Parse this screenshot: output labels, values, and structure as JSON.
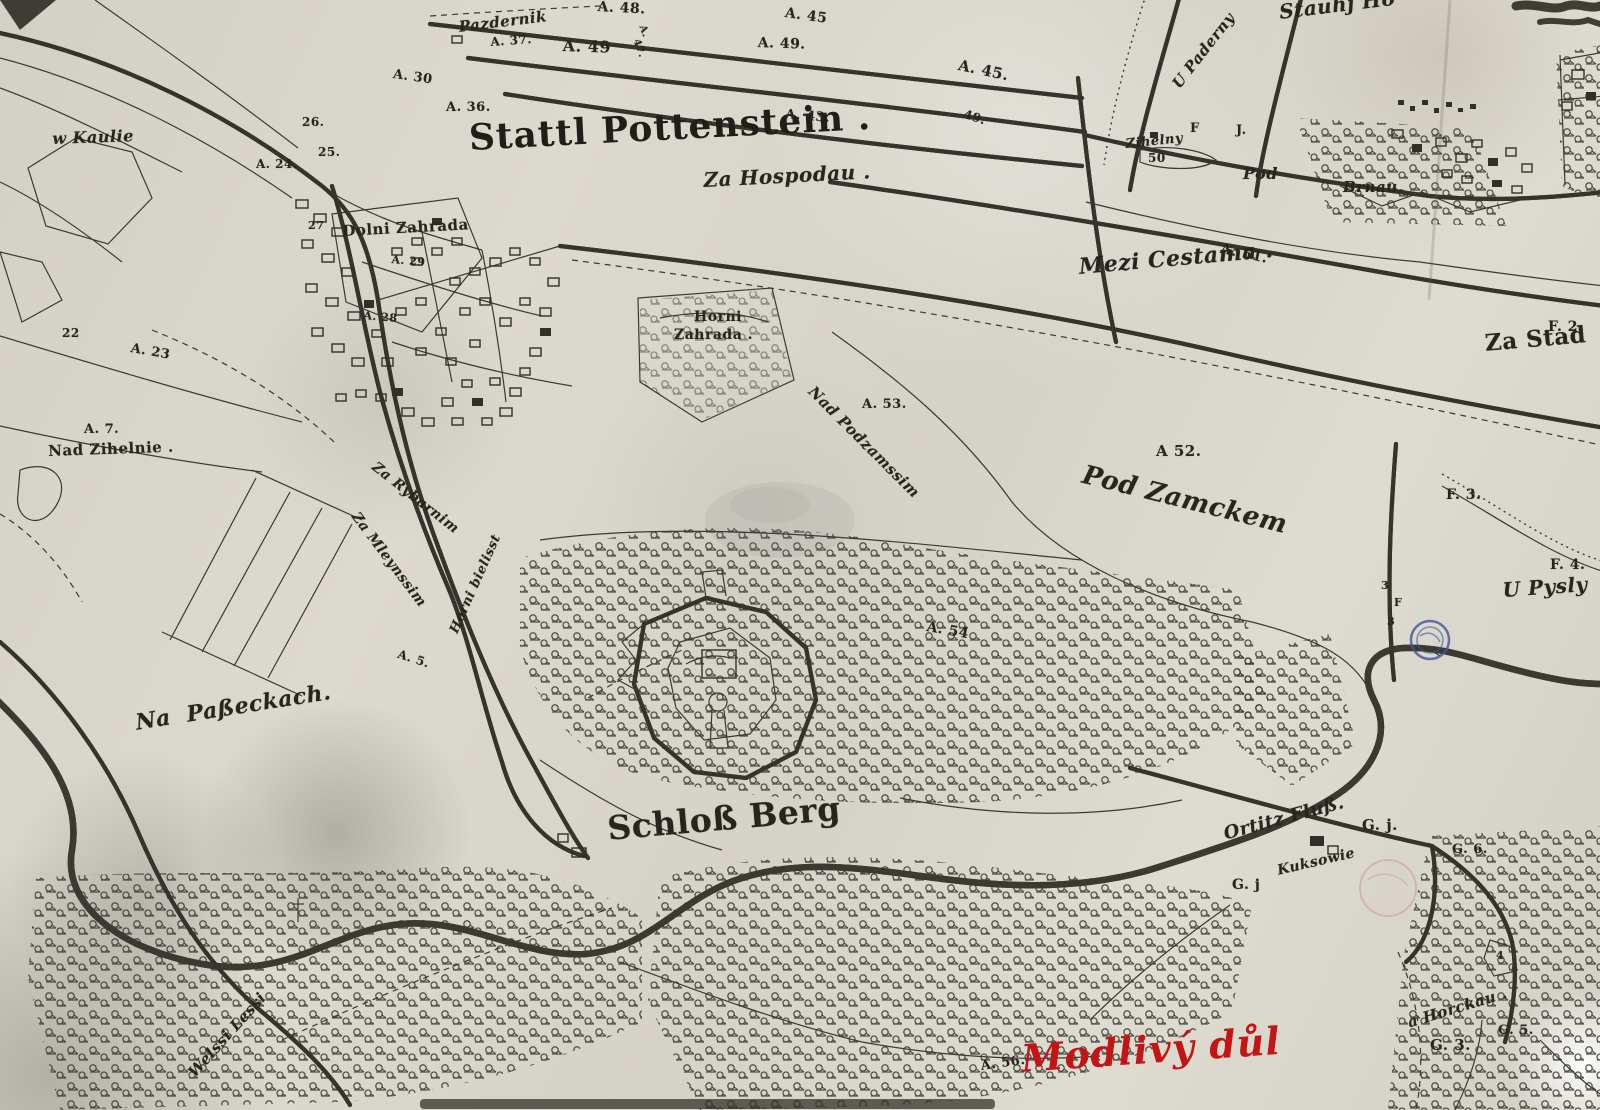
{
  "map": {
    "title": {
      "text": "Stattl Pottenstein ."
    },
    "colors": {
      "paper": "#d8d5cb",
      "ink": "#34342d",
      "red_ink": "#c41414",
      "blue_stamp": "#41549e",
      "red_stamp": "#c87878"
    },
    "annotations": {
      "red_note": "Modlivý důl"
    },
    "stamps": [
      {
        "type": "blue-double-circle",
        "x": 1430,
        "y": 640
      },
      {
        "type": "faint-red-seal",
        "x": 1388,
        "y": 888
      }
    ],
    "labels": [
      {
        "t": "A. 48.",
        "x": 598,
        "y": 0,
        "s": 14,
        "r": 3
      },
      {
        "t": "Pazdernik",
        "x": 458,
        "y": 20,
        "s": 15,
        "r": -7,
        "cls": "script"
      },
      {
        "t": "A. 37.",
        "x": 490,
        "y": 36,
        "s": 12,
        "r": -4
      },
      {
        "t": "A. 49",
        "x": 563,
        "y": 38,
        "s": 16,
        "r": 2
      },
      {
        "t": "A.",
        "x": 646,
        "y": 24,
        "s": 10,
        "r": 70
      },
      {
        "t": "47.",
        "x": 640,
        "y": 38,
        "s": 10,
        "r": 70
      },
      {
        "t": "A. 49.",
        "x": 758,
        "y": 36,
        "s": 14,
        "r": 2
      },
      {
        "t": "A. 45",
        "x": 786,
        "y": 6,
        "s": 14,
        "r": 8
      },
      {
        "t": "A. 45.",
        "x": 960,
        "y": 58,
        "s": 15,
        "r": 12
      },
      {
        "t": "49.",
        "x": 966,
        "y": 108,
        "s": 12,
        "r": 18
      },
      {
        "t": "A. 30",
        "x": 394,
        "y": 68,
        "s": 13,
        "r": 8
      },
      {
        "t": "A. 36.",
        "x": 446,
        "y": 101,
        "s": 13
      },
      {
        "t": "A. 43.",
        "x": 786,
        "y": 108,
        "s": 13,
        "r": 5
      },
      {
        "t": "U Paderny",
        "x": 1170,
        "y": 82,
        "s": 15,
        "r": -52,
        "cls": "script"
      },
      {
        "t": "Stauhj Ho",
        "x": 1278,
        "y": 2,
        "s": 20,
        "r": -7,
        "cls": "script"
      },
      {
        "t": "F",
        "x": 1190,
        "y": 122,
        "s": 13
      },
      {
        "t": "J.",
        "x": 1236,
        "y": 124,
        "s": 13
      },
      {
        "t": "Zihelny",
        "x": 1125,
        "y": 138,
        "s": 13,
        "r": -6,
        "cls": "script"
      },
      {
        "t": "50",
        "x": 1148,
        "y": 152,
        "s": 12
      },
      {
        "t": "Pod",
        "x": 1243,
        "y": 166,
        "s": 16,
        "cls": "script"
      },
      {
        "t": "Brnau.",
        "x": 1343,
        "y": 180,
        "s": 15,
        "cls": "script"
      },
      {
        "t": "Za Hospodau .",
        "x": 703,
        "y": 170,
        "s": 20,
        "r": -3,
        "cls": "script"
      },
      {
        "t": "Mezi Cestama .",
        "x": 1078,
        "y": 256,
        "s": 22,
        "r": -5,
        "cls": "script"
      },
      {
        "t": "A. 51.",
        "x": 1222,
        "y": 242,
        "s": 14,
        "r": 12
      },
      {
        "t": "F. 2.",
        "x": 1548,
        "y": 320,
        "s": 14
      },
      {
        "t": "Za Stad",
        "x": 1484,
        "y": 332,
        "s": 23,
        "r": -5
      },
      {
        "t": "w Kaulie",
        "x": 52,
        "y": 131,
        "s": 16,
        "r": -2,
        "cls": "script"
      },
      {
        "t": "26.",
        "x": 302,
        "y": 116,
        "s": 12
      },
      {
        "t": "25.",
        "x": 318,
        "y": 146,
        "s": 12
      },
      {
        "t": "A. 24.",
        "x": 256,
        "y": 158,
        "s": 12
      },
      {
        "t": "27",
        "x": 308,
        "y": 220,
        "s": 11
      },
      {
        "t": "Dolni Zahrada",
        "x": 342,
        "y": 224,
        "s": 15,
        "r": -3
      },
      {
        "t": "A. 29",
        "x": 392,
        "y": 254,
        "s": 11,
        "r": 5
      },
      {
        "t": "A. 28",
        "x": 364,
        "y": 310,
        "s": 11,
        "r": 5
      },
      {
        "t": "22",
        "x": 62,
        "y": 327,
        "s": 12
      },
      {
        "t": "A. 23",
        "x": 132,
        "y": 342,
        "s": 13,
        "r": 10
      },
      {
        "t": "A. 7.",
        "x": 84,
        "y": 423,
        "s": 13
      },
      {
        "t": "Nad Zihelnie .",
        "x": 48,
        "y": 444,
        "s": 15,
        "r": -2
      },
      {
        "t": "Horni",
        "x": 694,
        "y": 310,
        "s": 14
      },
      {
        "t": "Zahrada .",
        "x": 674,
        "y": 328,
        "s": 14
      },
      {
        "t": "Nad Podzamssim",
        "x": 816,
        "y": 384,
        "s": 15,
        "r": 45,
        "cls": "script"
      },
      {
        "t": "A. 53.",
        "x": 862,
        "y": 398,
        "s": 13
      },
      {
        "t": "A 52.",
        "x": 1156,
        "y": 444,
        "s": 15
      },
      {
        "t": "Pod Zamckem",
        "x": 1086,
        "y": 462,
        "s": 26,
        "r": 14,
        "cls": "script"
      },
      {
        "t": "Za Rybarnim",
        "x": 378,
        "y": 460,
        "s": 14,
        "r": 38,
        "cls": "script"
      },
      {
        "t": "Za Mleynssim",
        "x": 360,
        "y": 510,
        "s": 14,
        "r": 53,
        "cls": "script"
      },
      {
        "t": "Horni bielisst",
        "x": 448,
        "y": 630,
        "s": 13,
        "r": -66,
        "cls": "script"
      },
      {
        "t": "A. 5.",
        "x": 400,
        "y": 648,
        "s": 12,
        "r": 18
      },
      {
        "t": "Na  Paßeckach.",
        "x": 134,
        "y": 712,
        "s": 22,
        "r": -9,
        "cls": "script"
      },
      {
        "t": "A. 54",
        "x": 928,
        "y": 620,
        "s": 14,
        "r": 10
      },
      {
        "t": "F. 3.",
        "x": 1446,
        "y": 488,
        "s": 14
      },
      {
        "t": "3",
        "x": 1381,
        "y": 580,
        "s": 11
      },
      {
        "t": "F",
        "x": 1394,
        "y": 597,
        "s": 11
      },
      {
        "t": "3",
        "x": 1387,
        "y": 616,
        "s": 11
      },
      {
        "t": "F. 4.",
        "x": 1550,
        "y": 558,
        "s": 14
      },
      {
        "t": "U Pysly",
        "x": 1502,
        "y": 580,
        "s": 20,
        "r": -4,
        "cls": "script"
      },
      {
        "t": "Ortitz Fluß.",
        "x": 1222,
        "y": 826,
        "s": 18,
        "r": -15,
        "cls": "script"
      },
      {
        "t": "G. j.",
        "x": 1362,
        "y": 818,
        "s": 15
      },
      {
        "t": "G. j",
        "x": 1232,
        "y": 878,
        "s": 14
      },
      {
        "t": "Kuksowie",
        "x": 1276,
        "y": 864,
        "s": 14,
        "r": -13,
        "cls": "script"
      },
      {
        "t": "G. 6.",
        "x": 1452,
        "y": 843,
        "s": 13
      },
      {
        "t": "a Horckau .",
        "x": 1406,
        "y": 1016,
        "s": 15,
        "r": -17,
        "cls": "script"
      },
      {
        "t": "G. 3.",
        "x": 1430,
        "y": 1038,
        "s": 15
      },
      {
        "t": "G. 5.",
        "x": 1498,
        "y": 1024,
        "s": 13
      },
      {
        "t": "4",
        "x": 1496,
        "y": 950,
        "s": 11
      },
      {
        "t": "Schloß Berg",
        "x": 606,
        "y": 812,
        "s": 33,
        "r": -5
      },
      {
        "t": "A. 56.",
        "x": 980,
        "y": 1060,
        "s": 13,
        "r": -8
      },
      {
        "t": "Modlivý důl",
        "x": 1020,
        "y": 1040,
        "s": 38,
        "r": -4,
        "cls": "hand",
        "name": "handwritten-annotation"
      },
      {
        "t": "Welssi Lessi",
        "x": 186,
        "y": 1070,
        "s": 15,
        "r": -48,
        "cls": "script"
      }
    ]
  }
}
